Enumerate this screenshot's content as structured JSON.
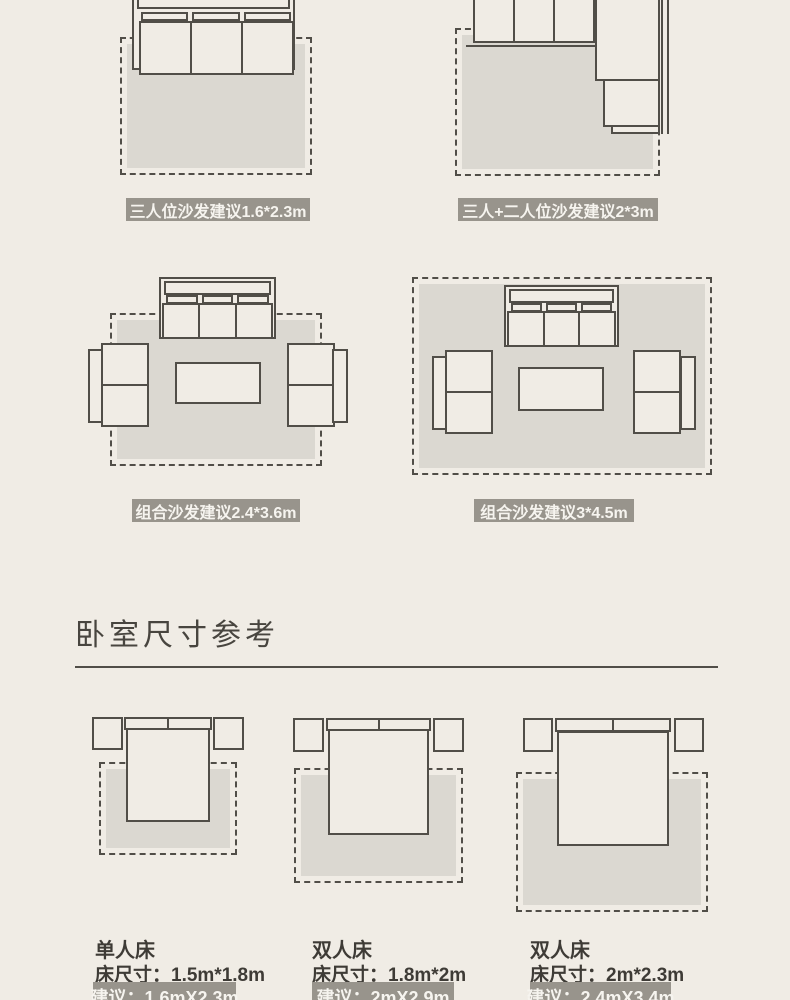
{
  "colors": {
    "background": "#F0ECE5",
    "rug": "#DBD8D1",
    "line": "#514E48",
    "badge_bg": "#98948C",
    "badge_text": "#F6F4EF",
    "text": "#3E3B36",
    "heading": "#48453F"
  },
  "living_room": {
    "diagrams": [
      {
        "name": "three-seat-sofa",
        "badge": "三人位沙发建议1.6*2.3m"
      },
      {
        "name": "three-plus-two-seat-sofa",
        "badge": "三人+二人位沙发建议2*3m"
      },
      {
        "name": "combo-sofa-small",
        "badge": "组合沙发建议2.4*3.6m"
      },
      {
        "name": "combo-sofa-large",
        "badge": "组合沙发建议3*4.5m"
      }
    ]
  },
  "bedroom": {
    "heading": "卧室尺寸参考",
    "beds": [
      {
        "type": "单人床",
        "bed_size": "床尺寸：1.5m*1.8m",
        "suggestion": "建议：1.6mX2.3m"
      },
      {
        "type": "双人床",
        "bed_size": "床尺寸：1.8m*2m",
        "suggestion": "建议：2mX2.9m"
      },
      {
        "type": "双人床",
        "bed_size": "床尺寸：2m*2.3m",
        "suggestion": "建议：2.4mX3.4m"
      }
    ]
  }
}
